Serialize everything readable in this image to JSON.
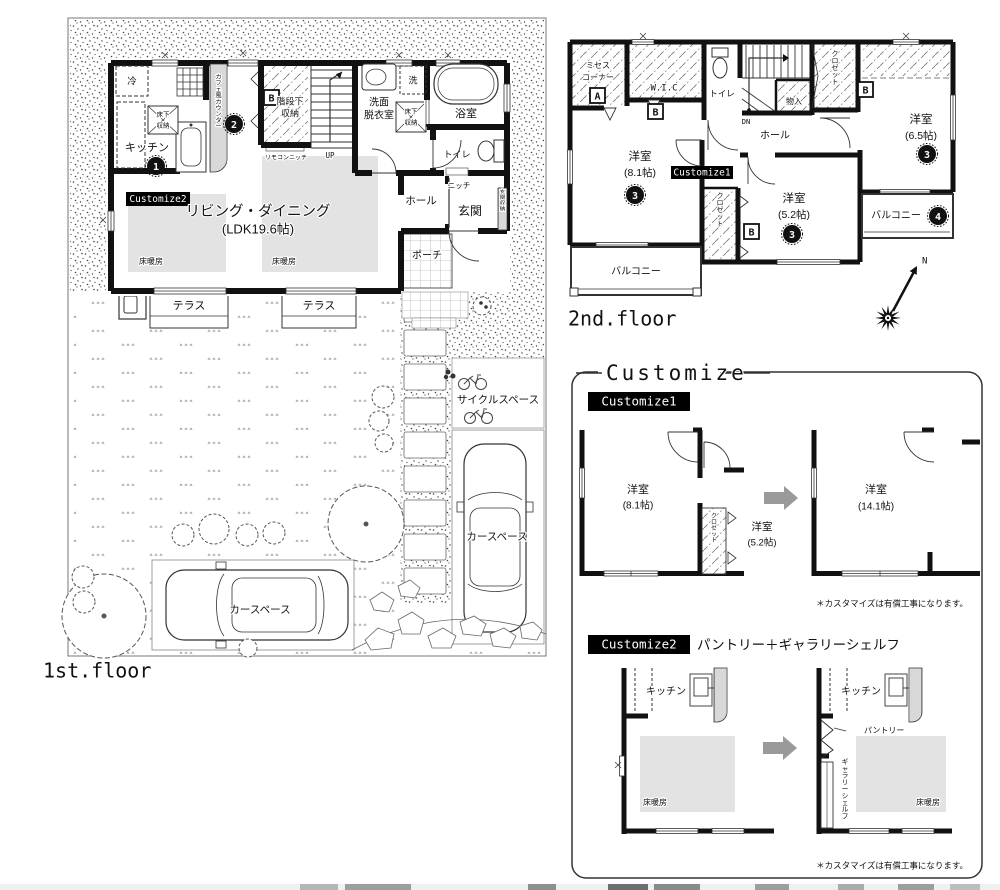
{
  "colors": {
    "wall": "#111111",
    "floor_heat": "#e3e3e3",
    "arrow": "#9a9a9a",
    "tag_bg": "#000000",
    "tag_fg": "#ffffff"
  },
  "floor1": {
    "label": "1st.floor",
    "living_name": "リビング・ダイニング",
    "living_size": "(LDK19.6帖)",
    "kitchen": "キッチン",
    "fridge": "冷",
    "underfloor_l1": "床下",
    "underfloor_l2": "収納",
    "counter_v": "カフェ風カウンター",
    "stair_storage_l1": "階段下",
    "stair_storage_l2": "収納",
    "remote_niche": "リモコンニッチ",
    "up": "UP",
    "washroom_l1": "洗面",
    "washroom_l2": "脱衣室",
    "washer": "洗",
    "bath": "浴室",
    "toilet": "トイレ",
    "niche": "ニッチ",
    "hall": "ホール",
    "entrance": "玄関",
    "entrance_storage_v": "玄関収納",
    "porch": "ポーチ",
    "floor_heating": "床暖房",
    "terrace": "テラス",
    "cycle_space": "サイクルスペース",
    "car_space": "カースペース",
    "customize2_tag": "Customize2",
    "marker_b": "B",
    "num1": "1",
    "num2": "2"
  },
  "floor2": {
    "label": "2nd.floor",
    "mrs_corner_l1": "ミセス",
    "mrs_corner_l2": "コーナー",
    "marker_a": "A",
    "marker_b": "B",
    "wic": "W.I.C",
    "toilet": "トイレ",
    "dn": "DN",
    "storage": "物入",
    "hall": "ホール",
    "closet_v": "クロゼット",
    "room": "洋室",
    "room81_size": "(8.1帖)",
    "room52_size": "(5.2帖)",
    "room65_size": "(6.5帖)",
    "balcony": "バルコニー",
    "customize1_tag": "Customize1",
    "num3": "3",
    "num4": "4",
    "north": "N"
  },
  "customize": {
    "title": "Customize",
    "c1_tag": "Customize1",
    "c2_tag": "Customize2",
    "c2_heading": "パントリー＋ギャラリーシェルフ",
    "room": "洋室",
    "room81_size": "(8.1帖)",
    "room52_size": "(5.2帖)",
    "room141_size": "(14.1帖)",
    "closet_v": "クロゼット",
    "kitchen": "キッチン",
    "pantry": "パントリー",
    "gallery_shelf_v": "ギャラリーシェルフ",
    "floor_heating": "床暖房",
    "note": "＊カスタマイズは有償工事になります。"
  }
}
